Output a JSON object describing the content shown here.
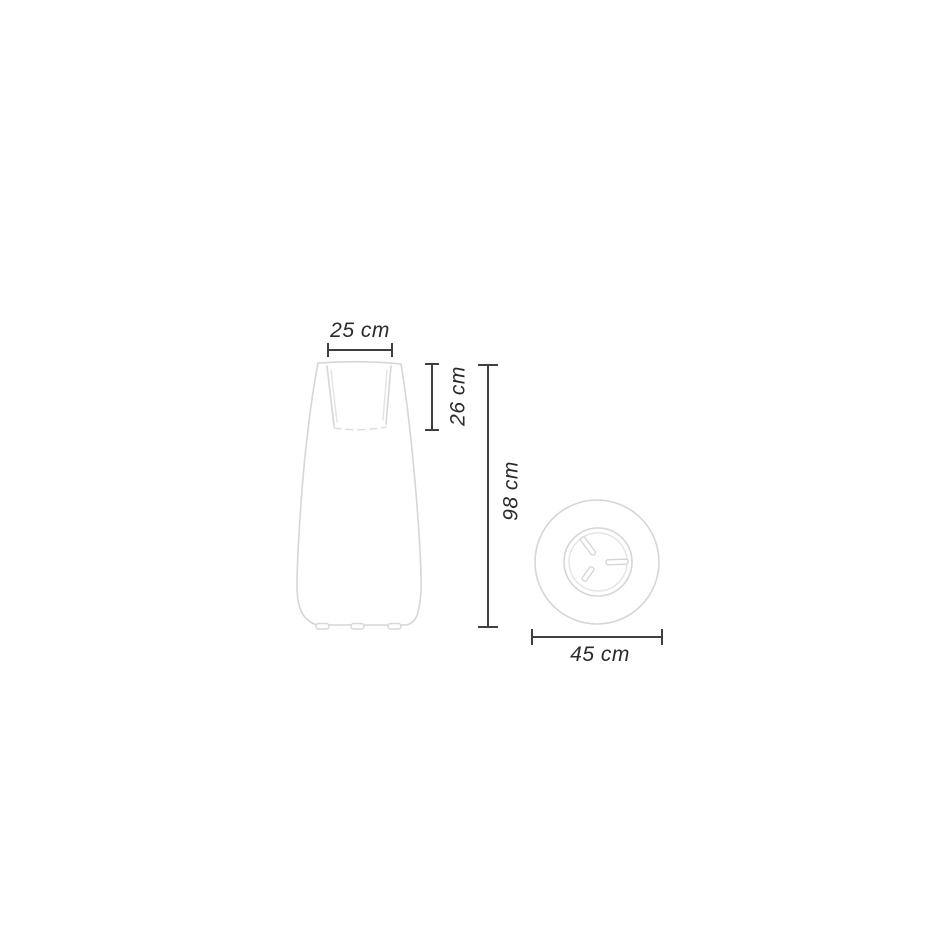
{
  "diagram": {
    "kind": "technical dimension drawing",
    "subject": "tall tapered planter shown in front view and top view",
    "views": {
      "front_view": "front elevation of planter",
      "top_view": "circular top view of planter base"
    },
    "dimensions": {
      "top_width": {
        "label": "25 cm",
        "value": 25,
        "unit": "cm"
      },
      "inner_depth": {
        "label": "26 cm",
        "value": 26,
        "unit": "cm"
      },
      "height": {
        "label": "98 cm",
        "value": 98,
        "unit": "cm"
      },
      "base_diameter": {
        "label": "45 cm",
        "value": 45,
        "unit": "cm"
      }
    },
    "colors": {
      "background": "#ffffff",
      "product_outline": "#d6d6d6",
      "dimension_lines": "#3f3f3f",
      "label_text": "#2b2b2b"
    }
  }
}
